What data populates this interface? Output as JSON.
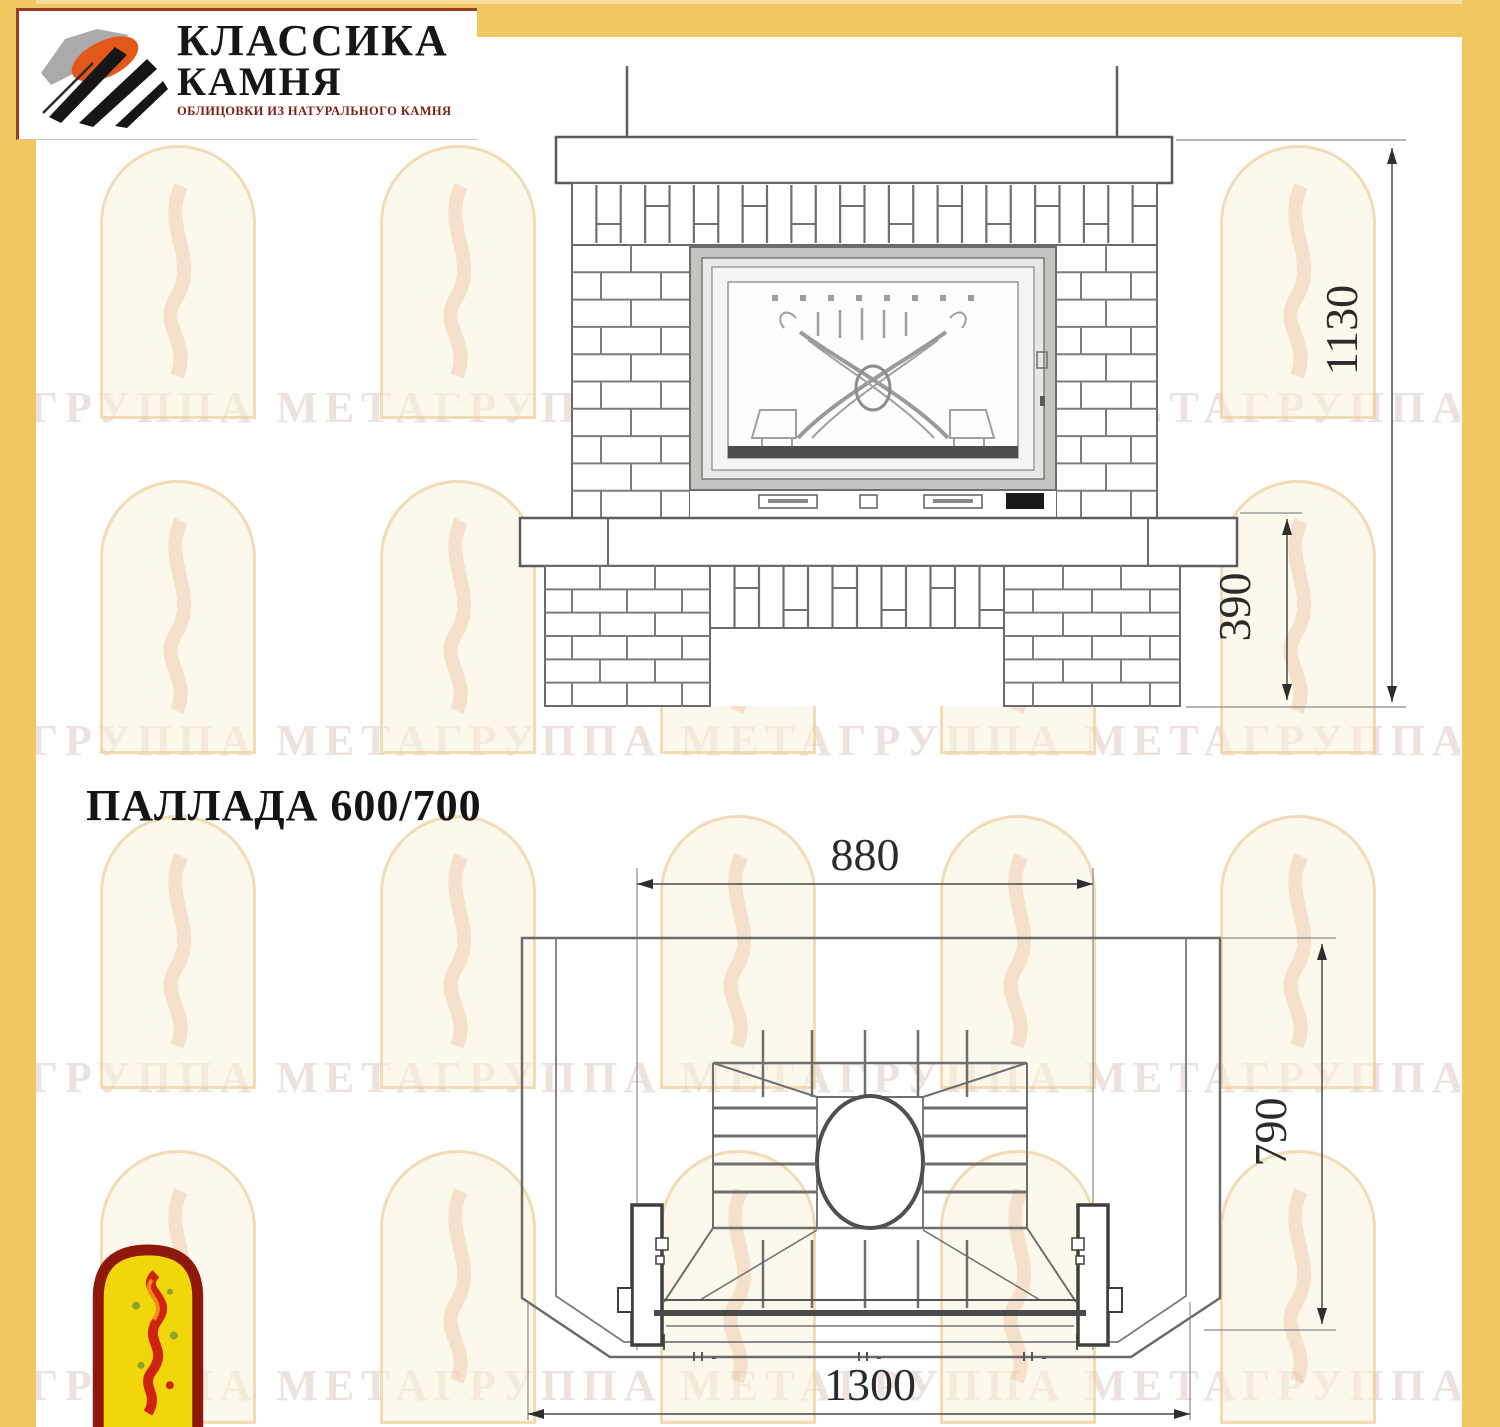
{
  "brand": {
    "line1": "КЛАССИКА",
    "line2": "КАМНЯ",
    "tagline": "ОБЛИЦОВКИ ИЗ НАТУРАЛЬНОГО КАМНЯ"
  },
  "title": "ПАЛЛАДА 600/700",
  "watermark_text": "ГРУППА МЕТАГРУППА МЕТАГРУППА МЕТАГРУППА МЕТАГРУППА МЕТА",
  "front_view": {
    "dims": {
      "total_height": "1130",
      "plinth_height": "390"
    }
  },
  "plan_view": {
    "dims": {
      "firebox_width": "880",
      "depth": "790",
      "total_width": "1300"
    }
  },
  "colors": {
    "border_yellow": "#f2c75f",
    "brand_red": "#9c3d22",
    "flame_logo_red": "#8e180b",
    "flame_logo_yellow": "#f2d60c",
    "brand_orange": "#e4571b",
    "drawing_line_gray": "#606060"
  }
}
